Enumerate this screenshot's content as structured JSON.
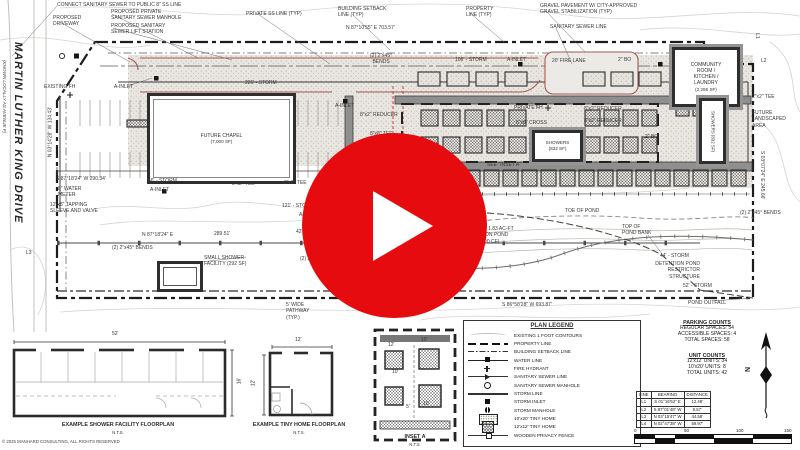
{
  "colors": {
    "play_red": "#e60b0e",
    "curb_brown": "#a3594e",
    "gravel_fill": "#e6e3de",
    "band_gray": "#8f8f8f"
  },
  "video": {
    "play_button": "play-icon"
  },
  "plan": {
    "street": {
      "name": "MARTIN LUTHER KING DRIVE",
      "alias": "(KNOWN LOCALLY AS AVENUE F)"
    },
    "buildings": {
      "chapel": {
        "name": "FUTURE CHAPEL",
        "area": "(7,000 SF)"
      },
      "community": {
        "name": "COMMUNITY\nROOM /\nKITCHEN /\nLAUNDRY",
        "area": "(2,295 SF)"
      },
      "showers_h": {
        "name": "SHOWERS",
        "area": "(832 SF)"
      },
      "showers_v": {
        "name": "SHOWERS (832 SF)"
      }
    },
    "annotations": [
      {
        "t": "CONNECT SANITARY SEWER TO PUBLIC 8\" SS LINE",
        "x": 57,
        "y": 2
      },
      {
        "t": "PROPOSED\nDRIVEWAY",
        "x": 53,
        "y": 15
      },
      {
        "t": "PROPOSED PRIVATE\nSANITARY SEWER MANHOLE",
        "x": 111,
        "y": 9
      },
      {
        "t": "PROPOSED SANITARY\nSEWER LIFT STATION",
        "x": 111,
        "y": 23
      },
      {
        "t": "PRIVATE SS LINE (TYP)",
        "x": 246,
        "y": 11
      },
      {
        "t": "BUILDING SETBACK\nLINE (TYP)",
        "x": 338,
        "y": 6
      },
      {
        "t": "N 87°10'55\" E  703.57'",
        "x": 346,
        "y": 25
      },
      {
        "t": "PROPERTY\nLINE (TYP)",
        "x": 466,
        "y": 6
      },
      {
        "t": "GRAVEL PAVEMENT W/ CITY-APPROVED\nGRAVEL STABILIZATION (TYP)",
        "x": 540,
        "y": 3
      },
      {
        "t": "SANITARY SEWER LINE",
        "x": 550,
        "y": 24
      },
      {
        "t": "EXISTING FH",
        "x": 44,
        "y": 84
      },
      {
        "t": "A-INLET",
        "x": 114,
        "y": 84
      },
      {
        "t": "226' - STORM",
        "x": 245,
        "y": 80
      },
      {
        "t": "(2) 2\"x45°\nBENDS",
        "x": 370,
        "y": 53,
        "al": "center"
      },
      {
        "t": "106' - STORM",
        "x": 455,
        "y": 57
      },
      {
        "t": "A-INLET",
        "x": 507,
        "y": 57
      },
      {
        "t": "20' FIRE LANE",
        "x": 552,
        "y": 58
      },
      {
        "t": "2\" BO",
        "x": 618,
        "y": 57
      },
      {
        "t": "L1",
        "x": 752,
        "y": 35,
        "r": 90,
        "w": 10
      },
      {
        "t": "L2",
        "x": 761,
        "y": 58
      },
      {
        "t": "2\"x2\" TEE",
        "x": 752,
        "y": 94
      },
      {
        "t": "FUTURE\nLANDSCAPED\nAREA",
        "x": 752,
        "y": 110
      },
      {
        "t": "A-INLET",
        "x": 335,
        "y": 103
      },
      {
        "t": "8\"x2\" REDUCER",
        "x": 360,
        "y": 112
      },
      {
        "t": "PRIVATE FH",
        "x": 514,
        "y": 105
      },
      {
        "t": "8\"x8\" CROSS",
        "x": 516,
        "y": 120
      },
      {
        "t": "8\"x8\" TEE",
        "x": 370,
        "y": 131
      },
      {
        "t": "8\"x8\" TEE",
        "x": 362,
        "y": 150
      },
      {
        "t": "8\"x2\" REDUCER",
        "x": 584,
        "y": 106
      },
      {
        "t": "8\"x2\" REDUCER",
        "x": 584,
        "y": 118
      },
      {
        "t": "2\" BO",
        "x": 645,
        "y": 134
      },
      {
        "t": "SEE \"INSET A\"",
        "x": 487,
        "y": 162
      },
      {
        "t": "66' - STORM",
        "x": 148,
        "y": 178
      },
      {
        "t": "8\"x2\" TEE",
        "x": 232,
        "y": 181
      },
      {
        "t": "8\"x2\" TEE",
        "x": 284,
        "y": 180
      },
      {
        "t": "S 87°18'24\" W  290.34'",
        "x": 56,
        "y": 176
      },
      {
        "t": "8\" WATER\nMETER",
        "x": 58,
        "y": 186
      },
      {
        "t": "A-INLET",
        "x": 150,
        "y": 187
      },
      {
        "t": "12\"x8\" TAPPING\nSLEEVE AND VALVE",
        "x": 50,
        "y": 202
      },
      {
        "t": "N 03°14'28\" W  134.43'",
        "x": 18,
        "y": 129,
        "w": 65,
        "r": -90,
        "al": "center"
      },
      {
        "t": "121' - STORM",
        "x": 282,
        "y": 203
      },
      {
        "t": "A-INLET",
        "x": 299,
        "y": 212
      },
      {
        "t": "42' - STORM",
        "x": 296,
        "y": 229
      },
      {
        "t": "N 87°18'24\" E",
        "x": 142,
        "y": 232
      },
      {
        "t": "289.51'",
        "x": 214,
        "y": 231
      },
      {
        "t": "(2) 2\"x45° BENDS",
        "x": 112,
        "y": 245
      },
      {
        "t": "SMALL SHOWER\nFACILITY (292 SF)",
        "x": 204,
        "y": 255
      },
      {
        "t": "(2) 2\"x45° BENDS",
        "x": 300,
        "y": 256
      },
      {
        "t": "5' WIDE\nPATHWAY\n(TYP.)",
        "x": 286,
        "y": 302
      },
      {
        "t": "E-INLET",
        "x": 353,
        "y": 303
      },
      {
        "t": "- STORM",
        "x": 461,
        "y": 210
      },
      {
        "t": "TOE OF POND",
        "x": 565,
        "y": 208
      },
      {
        "t": "PROPOSED 1.83 AC-FT\nDETENTION POND\n(80,000 CF)",
        "x": 455,
        "y": 226,
        "al": "center",
        "w": 62
      },
      {
        "t": "TOP OF\nPOND BANK",
        "x": 622,
        "y": 224
      },
      {
        "t": "44' - STORM",
        "x": 660,
        "y": 253
      },
      {
        "t": "DETENTION POND\nRESTRICTOR\nSTRUCTURE",
        "x": 630,
        "y": 261,
        "al": "right",
        "w": 70
      },
      {
        "t": "52' - STORM",
        "x": 683,
        "y": 283
      },
      {
        "t": "POND OUTFALL",
        "x": 688,
        "y": 300
      },
      {
        "t": "S 86°58'28\" W  693.87'",
        "x": 502,
        "y": 302
      },
      {
        "t": "S 03°07'24\" E  245.66'",
        "x": 727,
        "y": 172,
        "w": 70,
        "r": 90,
        "al": "center"
      },
      {
        "t": "(2) 2\"x45° BENDS",
        "x": 740,
        "y": 210
      },
      {
        "t": "L3",
        "x": 26,
        "y": 250
      }
    ]
  },
  "legend": {
    "title": "PLAN LEGEND",
    "items": [
      {
        "symbol": "contour",
        "label": "EXISTING 1 FOOT CONTOURS"
      },
      {
        "symbol": "property-line",
        "label": "PROPERTY LINE"
      },
      {
        "symbol": "setback-line",
        "label": "BUILDING SETBACK LINE"
      },
      {
        "symbol": "water-line",
        "label": "WATER LINE"
      },
      {
        "symbol": "fire-hydrant",
        "label": "FIRE HYDRANT"
      },
      {
        "symbol": "sanitary-line",
        "label": "SANITARY SEWER LINE"
      },
      {
        "symbol": "sanitary-manhole",
        "label": "SANITARY SEWER MANHOLE"
      },
      {
        "symbol": "storm-line",
        "label": "STORM LINE"
      },
      {
        "symbol": "storm-inlet",
        "label": "STORM INLET"
      },
      {
        "symbol": "storm-manhole",
        "label": "STORM MANHOLE"
      },
      {
        "symbol": "tiny-home-10x20",
        "label": "10'x20' TINY HOME"
      },
      {
        "symbol": "tiny-home-12x12",
        "label": "12'x12' TINY HOME"
      },
      {
        "symbol": "privacy-fence",
        "label": "WOODEN PRIVACY FENCE"
      }
    ]
  },
  "parking_counts": {
    "title": "PARKING COUNTS",
    "rows": [
      "REGULAR SPACES: 54",
      "ACCESSIBLE SPACES: 4",
      "TOTAL SPACES: 58"
    ]
  },
  "unit_counts": {
    "title": "UNIT COUNTS",
    "rows": [
      "12'x12' UNITS: 34",
      "10'x20' UNITS: 8",
      "TOTAL UNITS: 42"
    ]
  },
  "line_table": {
    "headers": [
      "LINE",
      "BEARING",
      "DISTANCE"
    ],
    "rows": [
      [
        "L1",
        "S 01°16'52\" E",
        "12.48'"
      ],
      [
        "L2",
        "S 87°01'48\" W",
        "8.57'"
      ],
      [
        "L3",
        "N 03°15'47\" W",
        "44.58'"
      ],
      [
        "L4",
        "N 02°47'38\" W",
        "59.97'"
      ]
    ]
  },
  "floorplans": {
    "shower": {
      "caption": "EXAMPLE SHOWER FACILITY FLOORPLAN",
      "nts": "N.T.S.",
      "dim_w": "52'",
      "dim_h": "16'"
    },
    "tiny": {
      "caption": "EXAMPLE TINY HOME FLOORPLAN",
      "nts": "N.T.S.",
      "dim_w": "12'",
      "dim_h": "12'"
    },
    "inset": {
      "caption": "INSET A",
      "nts": "N.T.S.",
      "dims": [
        "12'",
        "10'",
        "10'",
        "5'",
        "10'"
      ]
    }
  },
  "scale_bar": {
    "ticks": [
      "0",
      "50",
      "100",
      "150"
    ]
  },
  "north": {
    "label": "N"
  },
  "copyright": "© 2025 MANHARD CONSULTING, ALL RIGHTS RESERVED"
}
